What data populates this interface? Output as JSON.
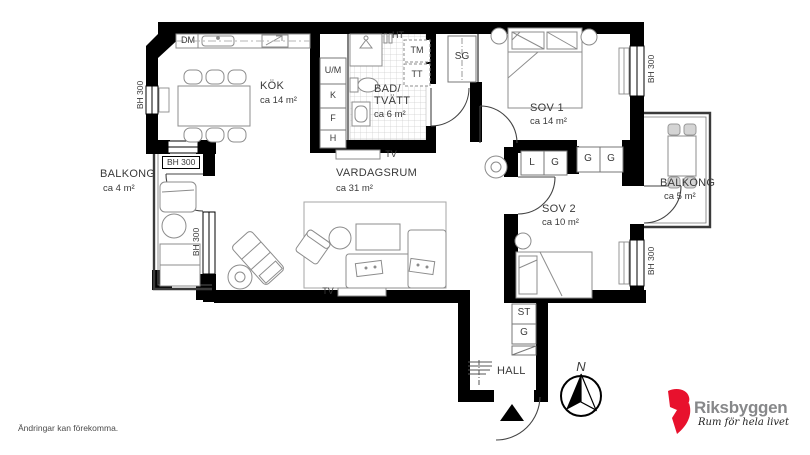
{
  "plan": {
    "rooms": {
      "kok": {
        "name": "KÖK",
        "area": "ca 14 m²"
      },
      "bad": {
        "name_line1": "BAD/",
        "name_line2": "TVÄTT",
        "area": "ca 6 m²"
      },
      "sov1": {
        "name": "SOV 1",
        "area": "ca 14 m²"
      },
      "sov2": {
        "name": "SOV 2",
        "area": "ca 10 m²"
      },
      "vardagsrum": {
        "name": "VARDAGSRUM",
        "area": "ca 31 m²"
      },
      "hall": {
        "name": "HALL"
      },
      "balkong_left": {
        "name": "BALKONG",
        "area": "ca 4 m²"
      },
      "balkong_right": {
        "name": "BALKONG",
        "area": "ca 5 m²"
      }
    },
    "fixtures": {
      "dm": "DM",
      "ht": "HT",
      "tm": "TM",
      "tt": "TT",
      "um": "U/M",
      "k": "K",
      "f": "F",
      "h": "H",
      "sg": "SG",
      "l": "L",
      "g": "G",
      "st": "ST",
      "tv": "TV"
    },
    "window_sill_label": "BH 300",
    "compass_north": "N"
  },
  "footer": {
    "disclaimer": "Ändringar kan förekomma."
  },
  "logo": {
    "brand": "Riksbyggen",
    "tagline": "Rum för hela livet",
    "brand_color": "#e8112d",
    "brand_text_color": "#87888a"
  }
}
